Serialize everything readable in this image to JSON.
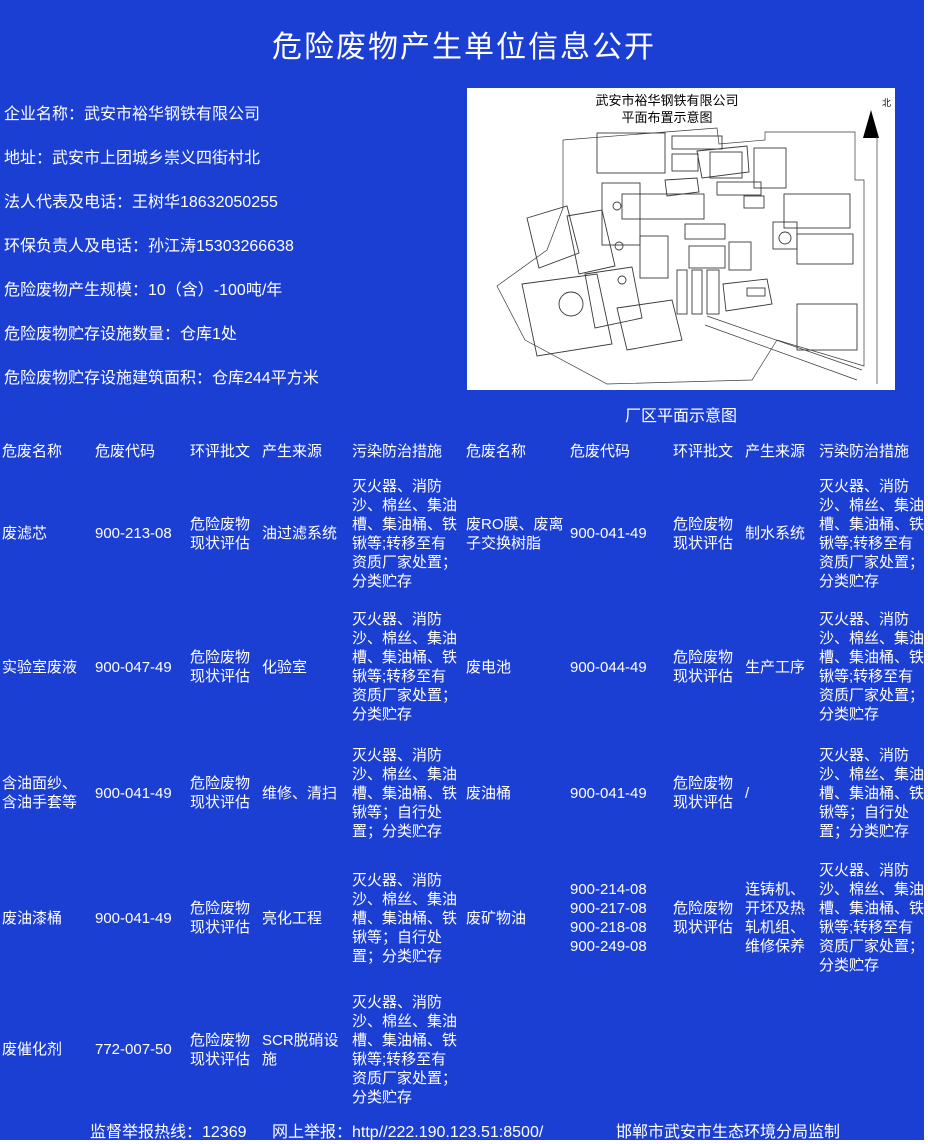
{
  "page": {
    "title": "危险废物产生单位信息公开",
    "bg_color": "#1c3fd3",
    "text_color": "#ffffff"
  },
  "info": {
    "lines": [
      "企业名称：武安市裕华钢铁有限公司",
      "地址：武安市上团城乡崇义四街村北",
      "法人代表及电话：王树华18632050255",
      "环保负责人及电话：孙江涛15303266638",
      "危险废物产生规模：10（含）-100吨/年",
      "危险废物贮存设施数量：仓库1处",
      "危险废物贮存设施建筑面积：仓库244平方米"
    ]
  },
  "map": {
    "title_line1": "武安市裕华钢铁有限公司",
    "title_line2": "平面布置示意图",
    "north_label": "北",
    "caption": "厂区平面示意图"
  },
  "table": {
    "headers": [
      "危废名称",
      "危废代码",
      "环评批文",
      "产生来源",
      "污染防治措施"
    ],
    "rows": [
      {
        "left": {
          "name": "废滤芯",
          "code": "900-213-08",
          "approval": "危险废物现状评估",
          "source": "油过滤系统",
          "measures": "灭火器、消防沙、棉丝、集油槽、集油桶、铁锹等;转移至有资质厂家处置；分类贮存"
        },
        "right": {
          "name": "废RO膜、废离子交换树脂",
          "code": "900-041-49",
          "approval": "危险废物现状评估",
          "source": "制水系统",
          "measures": "灭火器、消防沙、棉丝、集油槽、集油桶、铁锹等;转移至有资质厂家处置；分类贮存"
        }
      },
      {
        "left": {
          "name": "实验室废液",
          "code": "900-047-49",
          "approval": "危险废物现状评估",
          "source": "化验室",
          "measures": "灭火器、消防沙、棉丝、集油槽、集油桶、铁锹等;转移至有资质厂家处置；分类贮存"
        },
        "right": {
          "name": "废电池",
          "code": "900-044-49",
          "approval": "危险废物现状评估",
          "source": "生产工序",
          "measures": "灭火器、消防沙、棉丝、集油槽、集油桶、铁锹等;转移至有资质厂家处置；分类贮存"
        }
      },
      {
        "left": {
          "name": "含油面纱、含油手套等",
          "code": "900-041-49",
          "approval": "危险废物现状评估",
          "source": "维修、清扫",
          "measures": "灭火器、消防沙、棉丝、集油槽、集油桶、铁锹等；自行处置；分类贮存"
        },
        "right": {
          "name": "废油桶",
          "code": "900-041-49",
          "approval": "危险废物现状评估",
          "source": "/",
          "measures": "灭火器、消防沙、棉丝、集油槽、集油桶、铁锹等；自行处置；分类贮存"
        }
      },
      {
        "left": {
          "name": "废油漆桶",
          "code": "900-041-49",
          "approval": "危险废物现状评估",
          "source": "亮化工程",
          "measures": "灭火器、消防沙、棉丝、集油槽、集油桶、铁锹等；自行处置；分类贮存"
        },
        "right": {
          "name": "废矿物油",
          "code": "900-214-08\n900-217-08\n900-218-08\n900-249-08",
          "approval": "危险废物现状评估",
          "source": "连铸机、开坯及热轧机组、维修保养",
          "measures": "灭火器、消防沙、棉丝、集油槽、集油桶、铁锹等;转移至有资质厂家处置；分类贮存"
        }
      },
      {
        "left": {
          "name": "废催化剂",
          "code": "772-007-50",
          "approval": "危险废物现状评估",
          "source": "SCR脱硝设施",
          "measures": "灭火器、消防沙、棉丝、集油槽、集油桶、铁锹等;转移至有资质厂家处置；分类贮存"
        },
        "right": {
          "name": "",
          "code": "",
          "approval": "",
          "source": "",
          "measures": ""
        }
      }
    ]
  },
  "footer": {
    "hotline": "监督举报热线：12369",
    "online_report": "网上举报：http//222.190.123.51:8500/",
    "supervisor": "邯郸市武安市生态环境分局监制"
  }
}
